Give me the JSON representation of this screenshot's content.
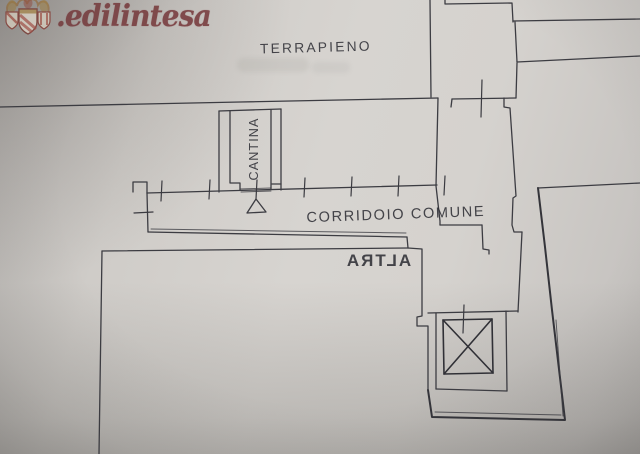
{
  "logo": {
    "brand_text": ".edilintesa",
    "icon": "heraldic-crest",
    "color": "#7b4143"
  },
  "plan": {
    "labels": {
      "terrapieno": "TERRAPIENO",
      "cantina": "CANTINA",
      "corridoio_comune": "CORRIDOIO COMUNE"
    },
    "ghost_bleedthrough_text": "ALTRA",
    "symbols": {
      "elevator": "crossed-box",
      "door": "triangle-door-swing",
      "measure_marks": "survey-tick-marks"
    },
    "colors": {
      "paper": "#d5d2ce",
      "ink": "#3c3c42",
      "logo_red": "#7b4143",
      "crest_gold": "#a5803a",
      "crest_red": "#a33f33"
    }
  }
}
